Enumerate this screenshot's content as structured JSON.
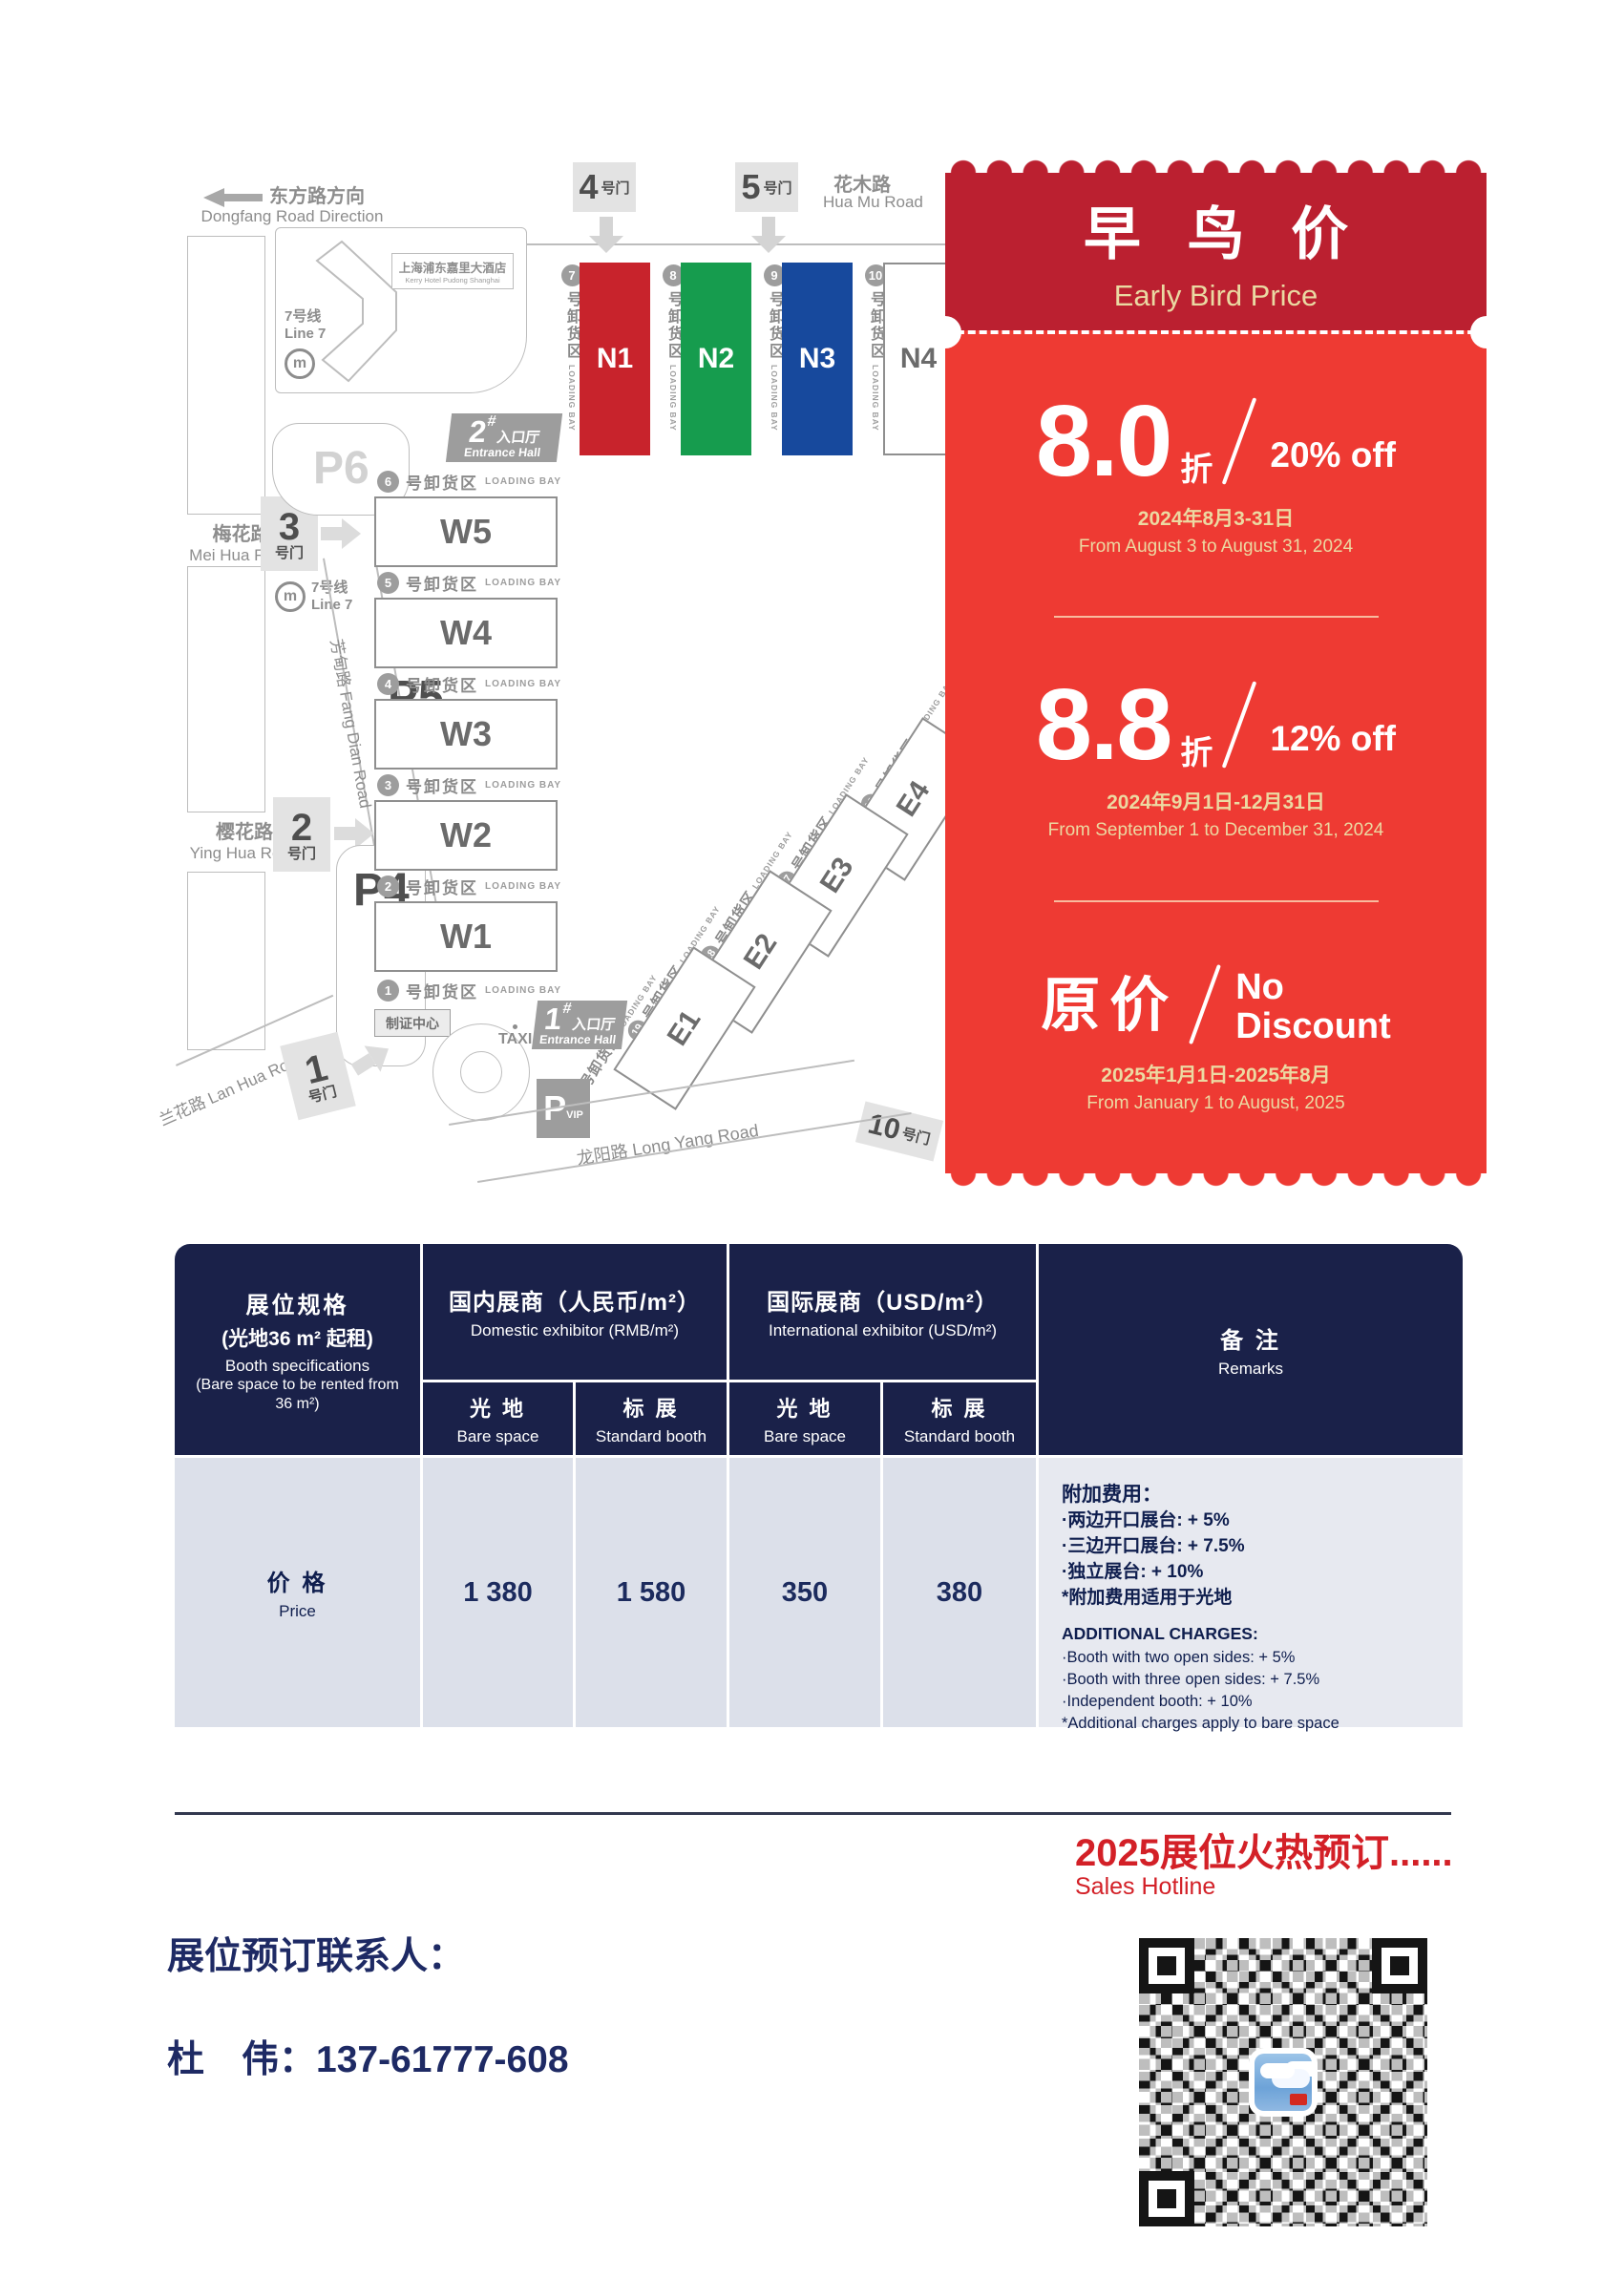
{
  "map": {
    "direction_cn": "东方路方向",
    "direction_en": "Dongfang Road Direction",
    "roads": {
      "huamu_cn": "花木路",
      "huamu_en": "Hua Mu Road",
      "meihua_cn": "梅花路",
      "meihua_en": "Mei Hua Road",
      "yinghua_cn": "樱花路",
      "yinghua_en": "Ying Hua Road",
      "lanhua": "兰花路 Lan Hua Road",
      "fangdian": "芳甸路  Fang Dian Road",
      "longyang": "龙阳路  Long Yang Road"
    },
    "gates": {
      "g4": "4",
      "g5": "5",
      "g3": "3",
      "g2": "2",
      "g1": "1",
      "g10": "10",
      "suffix": "号门"
    },
    "hotel_cn": "上海浦东嘉里大酒店",
    "hotel_en": "Kerry Hotel Pudong Shanghai",
    "metro_cn": "7号线",
    "metro_en": "Line 7",
    "metro_m": "m",
    "parking": {
      "p6": "P6",
      "p5": "P5",
      "p4": "P4",
      "pvip_main": "P",
      "pvip_sub": "VIP"
    },
    "entrance2": {
      "num": "2",
      "hash": "#",
      "hall_cn": "入口厅",
      "hall_en": "Entrance Hall"
    },
    "entrance1": {
      "num": "1",
      "hash": "#",
      "hall_cn": "入口厅",
      "hall_en": "Entrance Hall"
    },
    "taxi": "TAXI",
    "badge_center": "制证中心",
    "bay_cn": "号卸货区",
    "bay_en": "LOADING BAY",
    "w_halls": [
      "W5",
      "W4",
      "W3",
      "W2",
      "W1"
    ],
    "w_bays": [
      "6",
      "5",
      "4",
      "3",
      "2",
      "1"
    ],
    "n_halls": [
      "N1",
      "N2",
      "N3",
      "N4"
    ],
    "n_bays": [
      "7",
      "8",
      "9",
      "10"
    ],
    "e_halls": [
      "E4",
      "E3",
      "E2",
      "E1"
    ],
    "e_bays": [
      "16",
      "17",
      "18",
      "19",
      "20"
    ]
  },
  "coupon": {
    "title_cn": "早 鸟 价",
    "title_en": "Early Bird Price",
    "tier1": {
      "value": "8.0",
      "unit": "折",
      "off": "20% off",
      "date_cn": "2024年8月3-31日",
      "date_en": "From August 3 to August 31, 2024"
    },
    "tier2": {
      "value": "8.8",
      "unit": "折",
      "off": "12% off",
      "date_cn": "2024年9月1日-12月31日",
      "date_en": "From September 1 to December 31, 2024"
    },
    "tier3": {
      "value_cn": "原价",
      "off_line1": "No",
      "off_line2": "Discount",
      "date_cn": "2025年1月1日-2025年8月",
      "date_en": "From January 1 to August, 2025"
    }
  },
  "table": {
    "spec_cn": "展位规格",
    "spec_cn2": "(光地36 m² 起租)",
    "spec_en": "Booth specifications",
    "spec_en2": "(Bare space to be rented from 36 m²)",
    "domestic_cn": "国内展商（人民币/m²）",
    "domestic_en": "Domestic exhibitor (RMB/m²)",
    "intl_cn": "国际展商（USD/m²）",
    "intl_en": "International exhibitor (USD/m²)",
    "remarks_cn": "备  注",
    "remarks_en": "Remarks",
    "bare_cn": "光  地",
    "bare_en": "Bare space",
    "std_cn": "标  展",
    "std_en": "Standard booth",
    "price_cn": "价  格",
    "price_en": "Price",
    "values": [
      "1 380",
      "1 580",
      "350",
      "380"
    ],
    "remarks": {
      "cn_title": "附加费用：",
      "cn_lines": [
        "·两边开口展台: + 5%",
        "·三边开口展台: + 7.5%",
        "·独立展台: + 10%",
        "*附加费用适用于光地"
      ],
      "en_title": "ADDITIONAL CHARGES:",
      "en_lines": [
        "·Booth with two open sides: + 5%",
        "·Booth with three open sides: + 7.5%",
        "·Independent booth: + 10%",
        "*Additional charges apply to bare space"
      ]
    }
  },
  "footer": {
    "hotline_cn": "2025展位火热预订......",
    "hotline_en": "Sales Hotline",
    "contact_label": "展位预订联系人：",
    "contact": "杜　伟：137-61777-608"
  }
}
